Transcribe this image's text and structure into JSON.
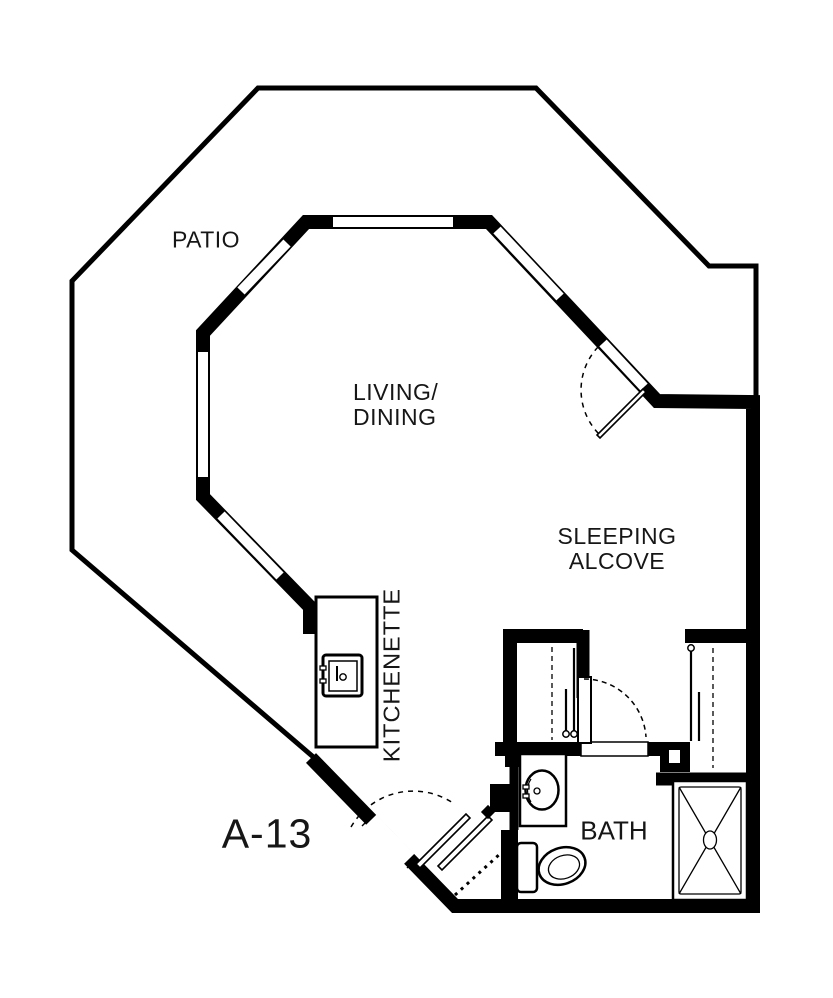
{
  "plan": {
    "type": "apartment-floor-plan",
    "unit_label": "A-13",
    "labels": {
      "patio": "PATIO",
      "living_line1": "LIVING/",
      "living_line2": "DINING",
      "sleeping_line1": "SLEEPING",
      "sleeping_line2": "ALCOVE",
      "kitchenette": "KITCHENETTE",
      "bath": "BATH"
    },
    "colors": {
      "wall": "#000000",
      "background": "#ffffff",
      "text": "#161616"
    }
  }
}
